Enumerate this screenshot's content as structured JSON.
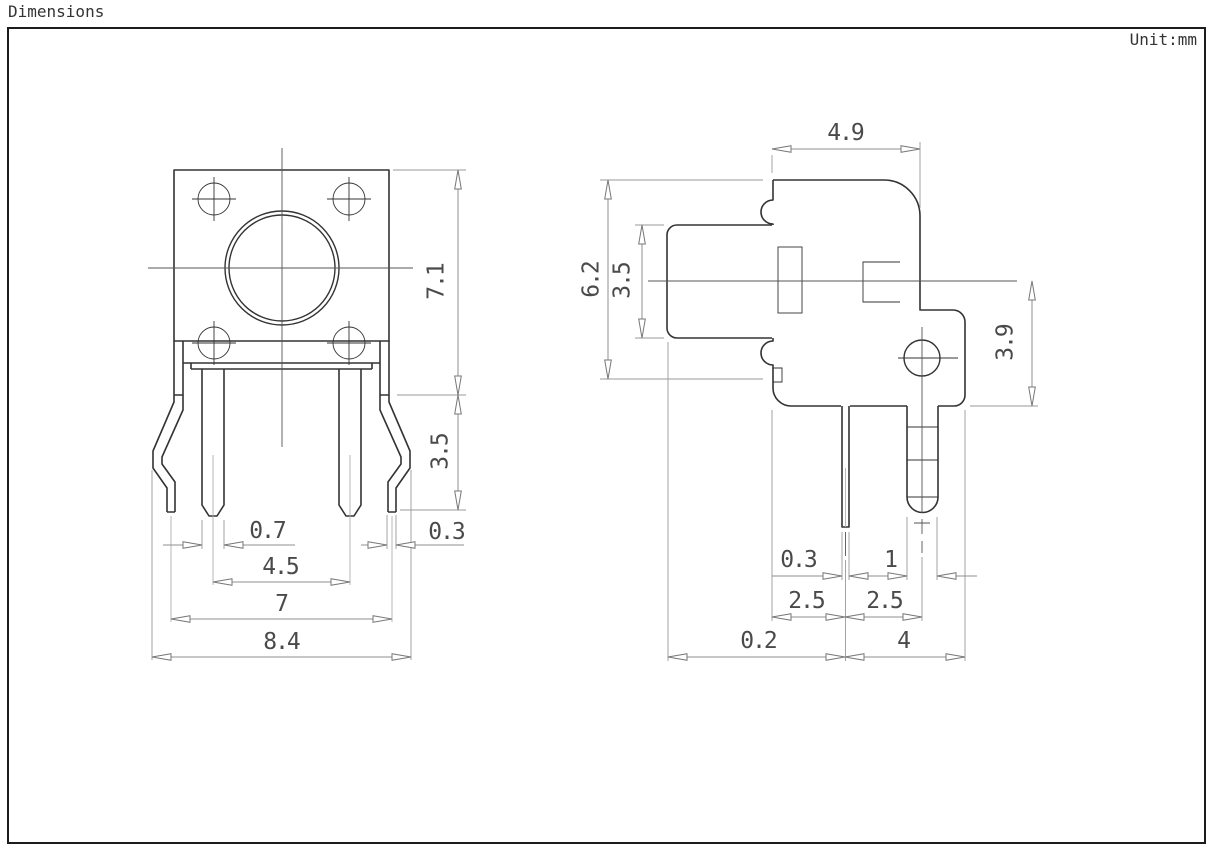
{
  "header": {
    "title": "Dimensions",
    "unit_label": "Unit:mm"
  },
  "colors": {
    "outline": "#333333",
    "dimension_lines": "#8f8f8f",
    "text": "#4a4a4a",
    "background": "#ffffff"
  },
  "front_view": {
    "name": "front view of tact switch",
    "dims": {
      "body_height": "7.1",
      "leg_height": "3.5",
      "pin_width": "0.7",
      "tip_width": "0.3",
      "pin_pitch": "4.5",
      "tip_span": "7",
      "overall_width": "8.4"
    }
  },
  "side_view": {
    "name": "side view of tact switch",
    "dims": {
      "top_width": "4.9",
      "body_height": "6.2",
      "stem_height": "3.5",
      "lower_height": "3.9",
      "pin1_width": "0.3",
      "pin2_width": "1",
      "pitch_left": "2.5",
      "pitch_right": "2.5",
      "offset_left": "0.2",
      "offset_right": "4"
    }
  }
}
